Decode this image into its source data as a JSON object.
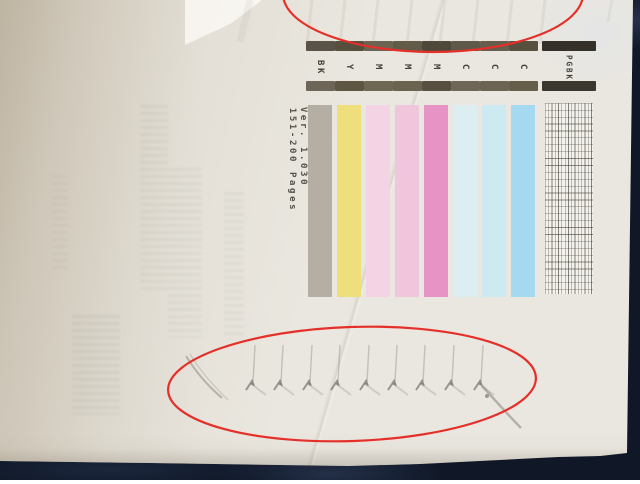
{
  "photo": {
    "background_color": "#101828",
    "paper_color": "#eae7e0",
    "annotation_color": "#e5302a"
  },
  "test_print": {
    "page_range": "151-200 Pages",
    "version": "Ver. 1.030",
    "columns": [
      {
        "label": "BK",
        "type": "solid",
        "bar_color": "#b5aea4",
        "header_top": "#5a5348",
        "header_bottom": "#6d6557"
      },
      {
        "label": "Y",
        "type": "solid",
        "bar_color": "#eede7c",
        "header_top": "#564f3c",
        "header_bottom": "#5d5643"
      },
      {
        "label": "M",
        "type": "solid",
        "bar_color": "#f3d3e4",
        "header_top": "#6b6453",
        "header_bottom": "#6e6754"
      },
      {
        "label": "M",
        "type": "solid",
        "bar_color": "#f0c6dd",
        "header_top": "#625b48",
        "header_bottom": "#6a6350"
      },
      {
        "label": "M",
        "type": "solid",
        "bar_color": "#e793c5",
        "header_top": "#4e483a",
        "header_bottom": "#575040"
      },
      {
        "label": "C",
        "type": "solid",
        "bar_color": "#dceef2",
        "header_top": "#5f5949",
        "header_bottom": "#6e6757"
      },
      {
        "label": "C",
        "type": "solid",
        "bar_color": "#cdeaf2",
        "header_top": "#655e4d",
        "header_bottom": "#6b6452"
      },
      {
        "label": "C",
        "type": "solid",
        "bar_color": "#a5d9ef",
        "header_top": "#57503f",
        "header_bottom": "#655e4b"
      },
      {
        "label": "PGBK",
        "type": "grid",
        "bar_color": "#f3f1ea",
        "header_top": "#343029",
        "header_bottom": "#3b372e"
      }
    ]
  }
}
